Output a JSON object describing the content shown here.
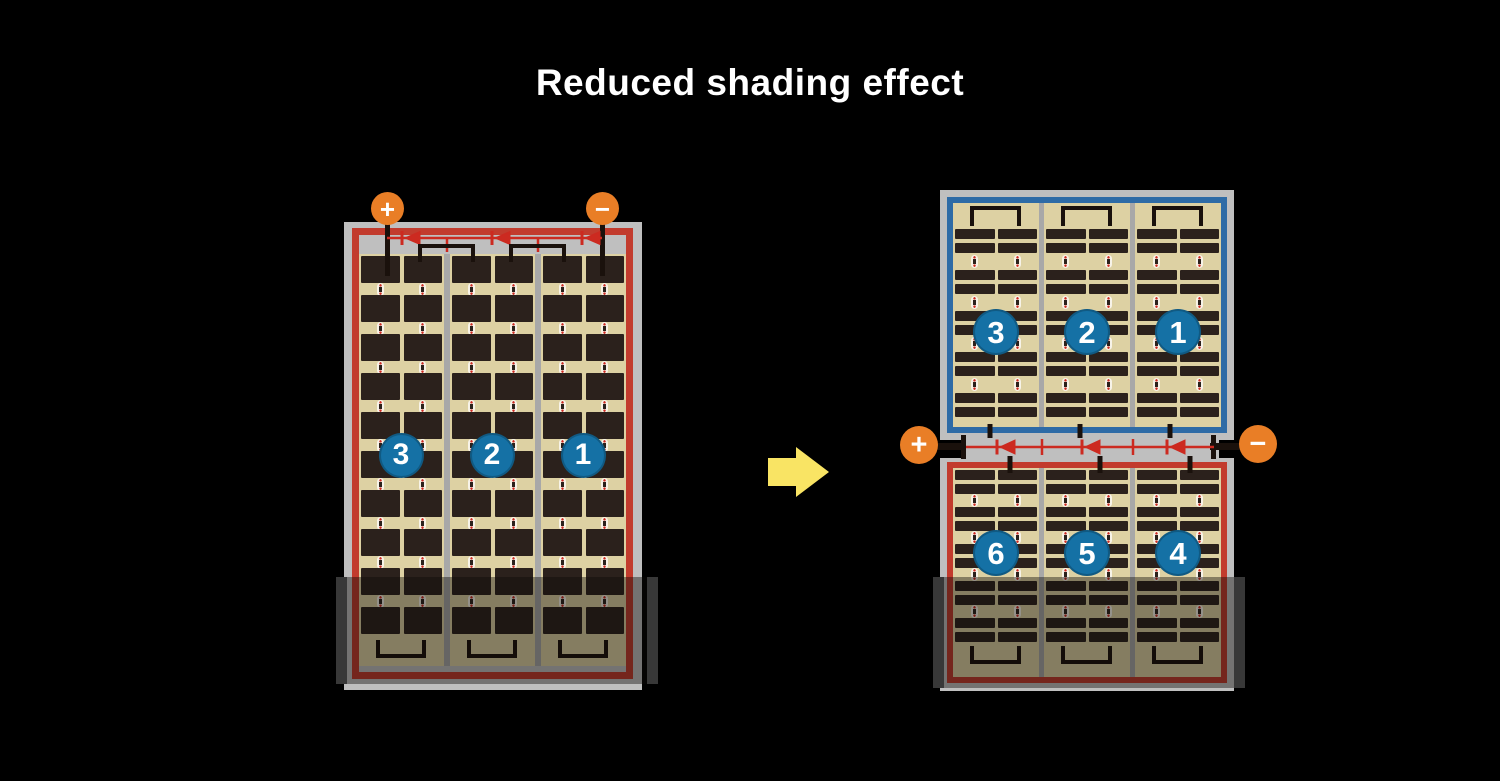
{
  "title": "Reduced shading effect",
  "colors": {
    "background": "#000000",
    "frame_gray": "#bfbfbf",
    "cell_dark": "#2b211c",
    "cell_background_tan": "#ddd1a3",
    "divider_gray": "#a8a8a8",
    "border_red": "#c23b2d",
    "border_blue": "#2e6ba6",
    "diode_red": "#cc2a20",
    "terminal_orange": "#e97e26",
    "circle_blue": "#1571a5",
    "arrow_yellow": "#f9e464",
    "wire_black": "#1a110c",
    "shade_overlay": "rgba(12,10,8,0.42)"
  },
  "left_module": {
    "terminals": {
      "positive": "+",
      "negative": "−"
    },
    "string_labels": [
      "3",
      "2",
      "1"
    ],
    "sections": 3,
    "columns_per_section": 2,
    "cell_rows": 10,
    "diodes_on_bus": 3,
    "shaded": true
  },
  "right_module": {
    "terminals": {
      "positive": "+",
      "negative": "−"
    },
    "top_string_labels": [
      "3",
      "2",
      "1"
    ],
    "bottom_string_labels": [
      "6",
      "5",
      "4"
    ],
    "sections": 3,
    "columns_per_section": 2,
    "top_strip_pairs": 5,
    "bottom_strip_pairs": 5,
    "diodes_on_bus": 3,
    "shaded": true
  },
  "arrow": {
    "direction": "right"
  }
}
